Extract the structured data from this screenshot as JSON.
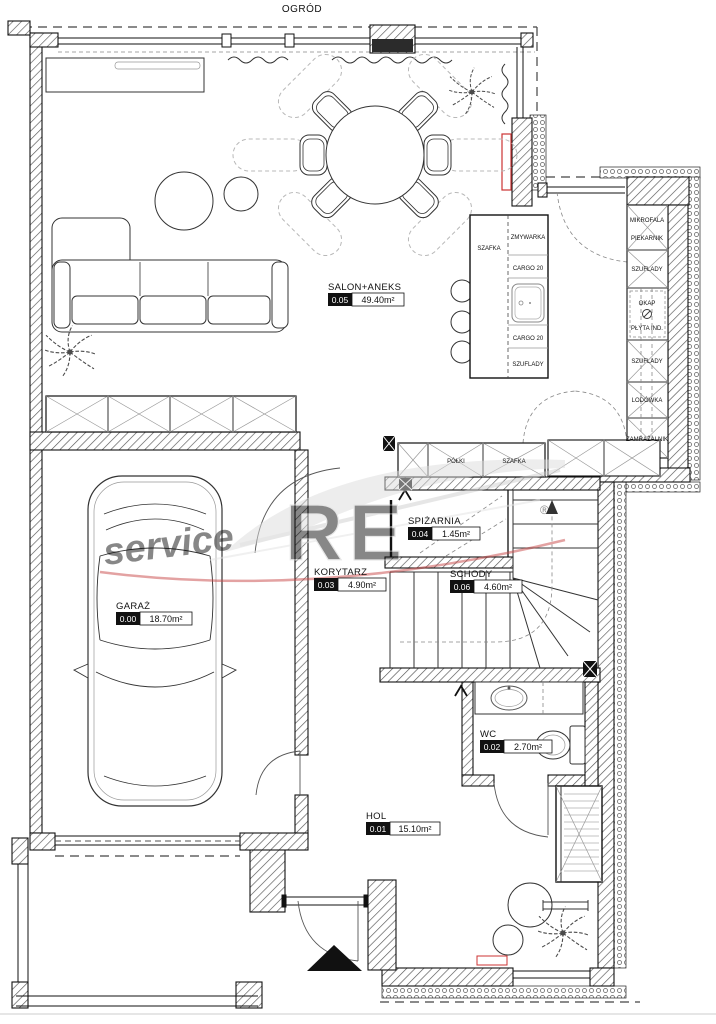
{
  "header": {
    "garden_label": "OGRÓD"
  },
  "watermark": {
    "brand": "RE",
    "text": "service",
    "reg": "®"
  },
  "rooms": [
    {
      "no": "0.05",
      "name": "SALON+ANEKS",
      "area": "49.40m²"
    },
    {
      "no": "0.00",
      "name": "GARAŻ",
      "area": "18.70m²"
    },
    {
      "no": "0.03",
      "name": "KORYTARZ",
      "area": "4.90m²"
    },
    {
      "no": "0.06",
      "name": "SCHODY",
      "area": "4.60m²"
    },
    {
      "no": "0.04",
      "name": "SPIŻARNIA",
      "area": "1.45m²"
    },
    {
      "no": "0.02",
      "name": "WC",
      "area": "2.70m²"
    },
    {
      "no": "0.01",
      "name": "HOL",
      "area": "15.10m²"
    }
  ],
  "kitchen": {
    "island": {
      "side": "SZAFKA",
      "c1": "ZMYWARKA",
      "c2": "CARGO 20",
      "c3": "CARGO 20",
      "c4": "SZUFLADY"
    },
    "wall": {
      "r1a": "MIKROFALA",
      "r1b": "PIEKARNIK",
      "r2": "SZUFLADY",
      "r3a": "OKAP",
      "r3b": "PŁYTA IND.",
      "r4": "SZUFLADY",
      "r5": "LODÓWKA",
      "r6": "ZAMRAŻALNIK"
    },
    "hall": {
      "c1": "PÓŁKI",
      "c2": "SZAFKA"
    }
  },
  "colors": {
    "accent_red": "#cc3333",
    "wall_line": "#1a1a1a"
  }
}
